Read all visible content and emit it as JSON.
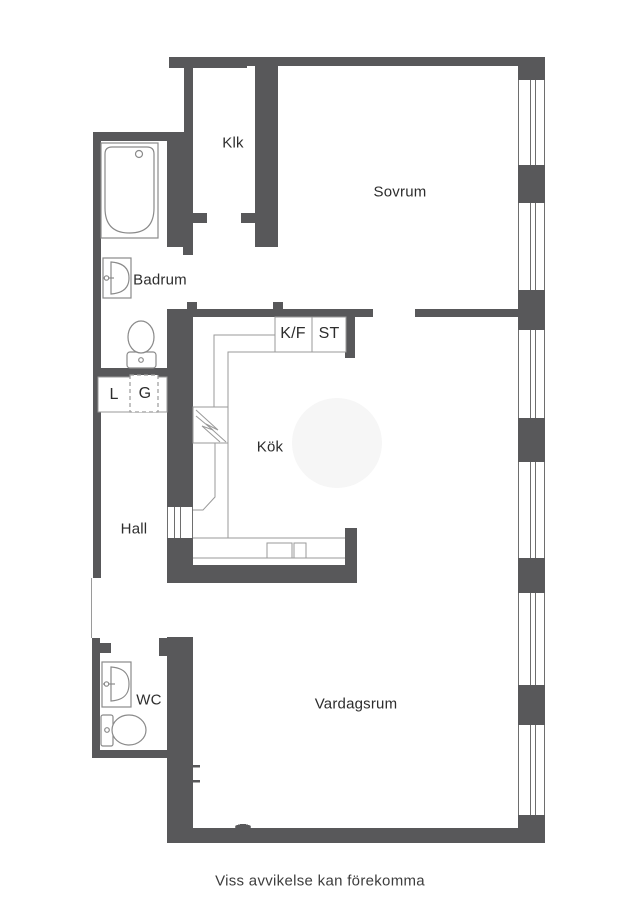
{
  "plan": {
    "footer_note": "Viss avvikelse kan förekomma",
    "colors": {
      "wall": "#58585a",
      "line": "#9a9a9a",
      "window_line": "#6e6e6e",
      "fixture": "#8a8a8a",
      "text": "#2d2d2d",
      "footer_text": "#3d3d3d",
      "table_fill": "#f6f6f6"
    },
    "rooms": {
      "klk": "Klk",
      "sovrum": "Sovrum",
      "badrum": "Badrum",
      "kok": "Kök",
      "hall": "Hall",
      "wc": "WC",
      "vardagsrum": "Vardagsrum"
    },
    "closets": {
      "kf": "K/F",
      "st": "ST",
      "l": "L",
      "g": "G"
    }
  }
}
